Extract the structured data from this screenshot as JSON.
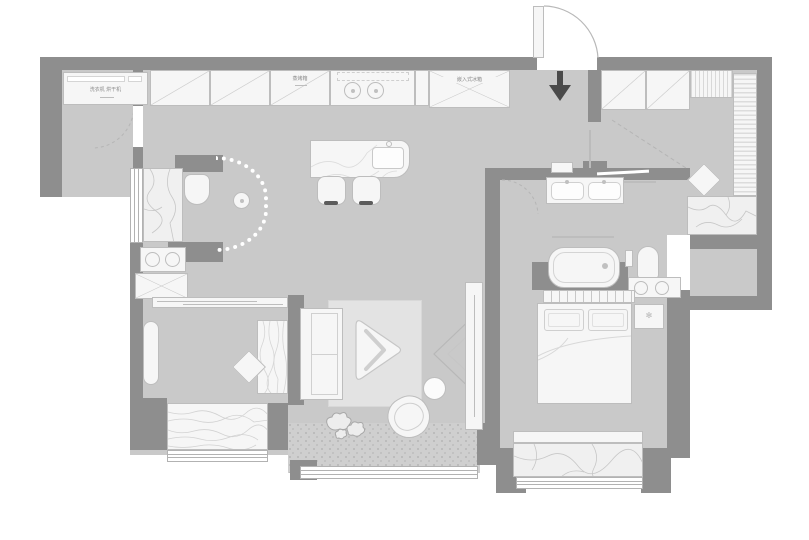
{
  "title": "apartment-floor-plan",
  "labels": {
    "washer_dryer": "洗衣机 烘干机",
    "steam_oven": "蒸烤箱",
    "fridge": "嵌入式冰箱"
  },
  "icons": {
    "entry_arrow": "↓",
    "nightstand_flower": "✻"
  },
  "colors": {
    "wall": "#8e8e8e",
    "floor": "#c9c9c9",
    "fixture": "#f6f6f6",
    "outline": "#bdbdbd",
    "rug": "#e3e3e3",
    "marble": "#f0f0f0",
    "vein": "#c7c7c7",
    "balcony": "#cfcfcf",
    "speckle": "#b6b6b6",
    "arrow": "#4a4a4a",
    "dotted": "#ffffff",
    "text": "#8a8a8a",
    "winline": "#b2b2b2",
    "grain": "#d8d8d8"
  }
}
